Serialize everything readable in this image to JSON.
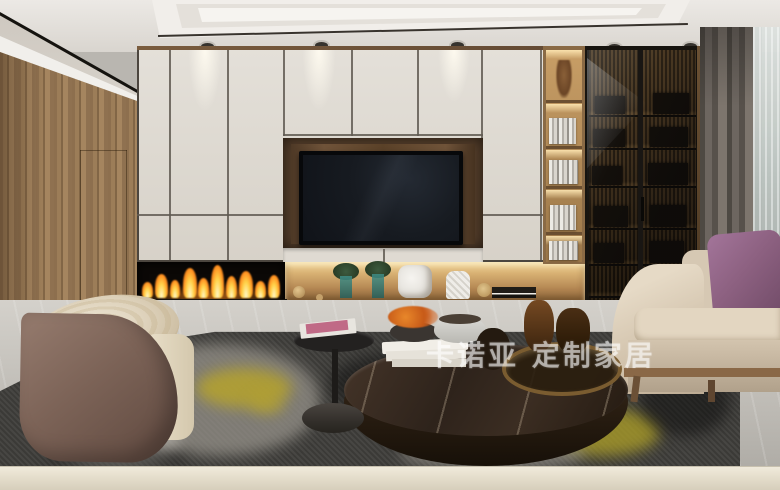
{
  "image_type": "interior-design-rendering",
  "watermark": {
    "text": "卡诺亚 定制家居",
    "brand": "卡诺亚",
    "tagline": "定制家居"
  },
  "scene": {
    "room": "modern living room",
    "objects": [
      "recessed ceiling spotlights",
      "wood accent wall with hidden door",
      "cream built-in cabinet wall",
      "wall-recessed tv in walnut niche",
      "linear fireplace with flames",
      "lit decor niche with plants and vases",
      "open bookshelf column with books",
      "smoked-glass bookcase with black frame",
      "gray blackout curtain",
      "white sheer curtain",
      "beige fabric sofa",
      "purple accent pillow",
      "curved suede armchair with onyx top",
      "round dark-marble coffee table with bronze tray",
      "black round side table with magazines",
      "charcoal area rug with yellow accents",
      "light marble floor"
    ]
  },
  "colors": {
    "ceiling": "#e7e4df",
    "wood_wall": "#96754f",
    "cabinet": "#ddd8d0",
    "tv_screen": "#171b21",
    "flame_orange": "#ff8e1f",
    "shelf_wood": "#b08d5c",
    "glass_cabinet": "#2a2015",
    "curtain_gray": "#6b645d",
    "sofa_beige": "#d5c7b2",
    "pillow_purple": "#8d6181",
    "armchair_brown": "#7c6357",
    "table_marble": "#32261b",
    "rug_dark": "#454440",
    "rug_yellow": "#b3a12d",
    "floor": "#c9c6c0",
    "foreground_blur": "#e7e0d0",
    "watermark": "#ffffff"
  }
}
